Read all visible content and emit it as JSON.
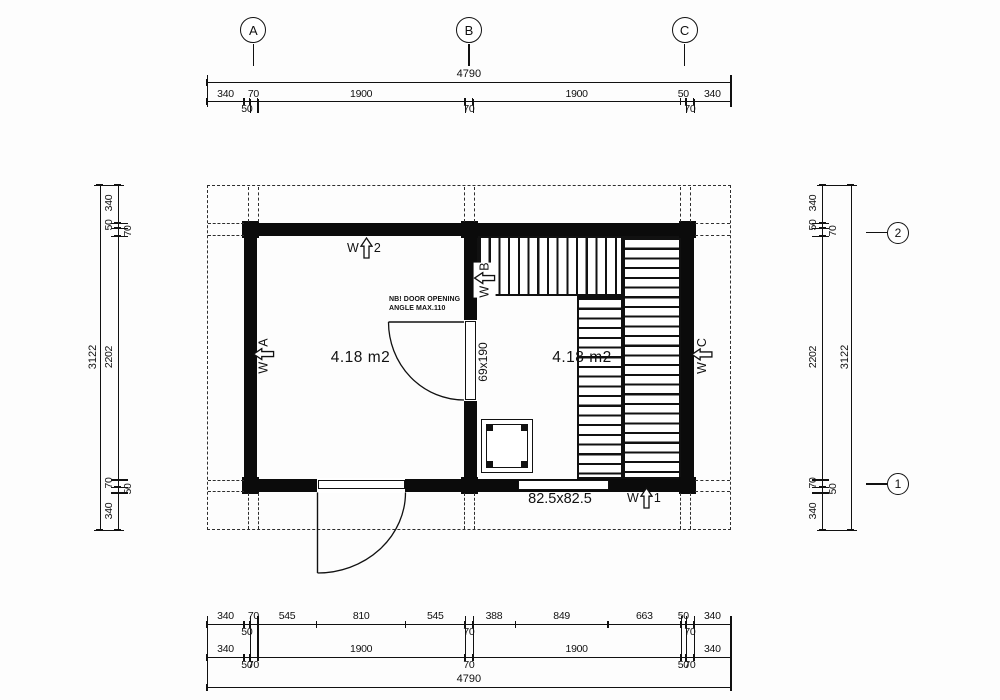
{
  "drawing": {
    "grid_columns": [
      {
        "label": "A"
      },
      {
        "label": "B"
      },
      {
        "label": "C"
      }
    ],
    "grid_rows": [
      {
        "label": "2"
      },
      {
        "label": "1"
      }
    ],
    "rooms": [
      {
        "name": "front-room",
        "area_label": "4.18 m2"
      },
      {
        "name": "sauna-room",
        "area_label": "4.18 m2"
      }
    ],
    "notes": {
      "door_note_line1": "NB! DOOR OPENING",
      "door_note_line2": "ANGLE MAX.110"
    },
    "labels": {
      "interior_door_size": "69x190",
      "window_size": "82.5x82.5"
    },
    "openings": [
      {
        "mark": "W",
        "id": "2",
        "location": "top-wall"
      },
      {
        "mark": "W",
        "id": "A",
        "location": "left-wall"
      },
      {
        "mark": "W",
        "id": "B",
        "location": "interior-wall"
      },
      {
        "mark": "W",
        "id": "C",
        "location": "right-wall"
      },
      {
        "mark": "W",
        "id": "1",
        "location": "bottom-wall"
      }
    ],
    "colors": {
      "line": "#111111",
      "wall": "#0b0b0b",
      "background": "#fdfdfd"
    },
    "dimensions": {
      "top": {
        "total": "4790",
        "segments": [
          {
            "v": 340,
            "label": "340",
            "side": "above"
          },
          {
            "v": 50,
            "label": "50",
            "side": "below"
          },
          {
            "v": 70,
            "label": "70",
            "side": "above"
          },
          {
            "v": 1900,
            "label": "1900",
            "side": "above"
          },
          {
            "v": 70,
            "label": "70",
            "side": "below"
          },
          {
            "v": 1900,
            "label": "1900",
            "side": "above"
          },
          {
            "v": 50,
            "label": "50",
            "side": "above"
          },
          {
            "v": 70,
            "label": "70",
            "side": "below"
          },
          {
            "v": 340,
            "label": "340",
            "side": "above"
          }
        ]
      },
      "bottom": {
        "total": "4790",
        "detail_segments": [
          {
            "v": 340,
            "label": "340",
            "side": "above"
          },
          {
            "v": 50,
            "label": "50",
            "side": "below"
          },
          {
            "v": 70,
            "label": "70",
            "side": "above"
          },
          {
            "v": 545,
            "label": "545",
            "side": "above"
          },
          {
            "v": 810,
            "label": "810",
            "side": "above"
          },
          {
            "v": 545,
            "label": "545",
            "side": "above"
          },
          {
            "v": 70,
            "label": "70",
            "side": "below"
          },
          {
            "v": 388,
            "label": "388",
            "side": "above"
          },
          {
            "v": 849,
            "label": "849",
            "side": "above"
          },
          {
            "v": 663,
            "label": "663",
            "side": "above"
          },
          {
            "v": 50,
            "label": "50",
            "side": "above"
          },
          {
            "v": 70,
            "label": "70",
            "side": "below"
          },
          {
            "v": 340,
            "label": "340",
            "side": "above"
          }
        ],
        "main_segments": [
          {
            "v": 340,
            "label": "340",
            "side": "above"
          },
          {
            "v": 50,
            "label": "50",
            "side": "below"
          },
          {
            "v": 70,
            "label": "70",
            "side": "below"
          },
          {
            "v": 1900,
            "label": "1900",
            "side": "above"
          },
          {
            "v": 70,
            "label": "70",
            "side": "below"
          },
          {
            "v": 1900,
            "label": "1900",
            "side": "above"
          },
          {
            "v": 50,
            "label": "50",
            "side": "below"
          },
          {
            "v": 70,
            "label": "70",
            "side": "below"
          },
          {
            "v": 340,
            "label": "340",
            "side": "above"
          }
        ]
      },
      "left": {
        "total": "3122",
        "segments": [
          {
            "v": 340,
            "label": "340",
            "side": "out"
          },
          {
            "v": 50,
            "label": "50",
            "side": "out"
          },
          {
            "v": 70,
            "label": "70",
            "side": "in"
          },
          {
            "v": 2202,
            "label": "2202",
            "side": "out"
          },
          {
            "v": 70,
            "label": "70",
            "side": "out"
          },
          {
            "v": 50,
            "label": "50",
            "side": "in"
          },
          {
            "v": 340,
            "label": "340",
            "side": "out"
          }
        ]
      },
      "right": {
        "total": "3122",
        "segments": [
          {
            "v": 340,
            "label": "340",
            "side": "out"
          },
          {
            "v": 50,
            "label": "50",
            "side": "out"
          },
          {
            "v": 70,
            "label": "70",
            "side": "in"
          },
          {
            "v": 2202,
            "label": "2202",
            "side": "out"
          },
          {
            "v": 70,
            "label": "70",
            "side": "out"
          },
          {
            "v": 50,
            "label": "50",
            "side": "in"
          },
          {
            "v": 340,
            "label": "340",
            "side": "out"
          }
        ]
      }
    }
  }
}
